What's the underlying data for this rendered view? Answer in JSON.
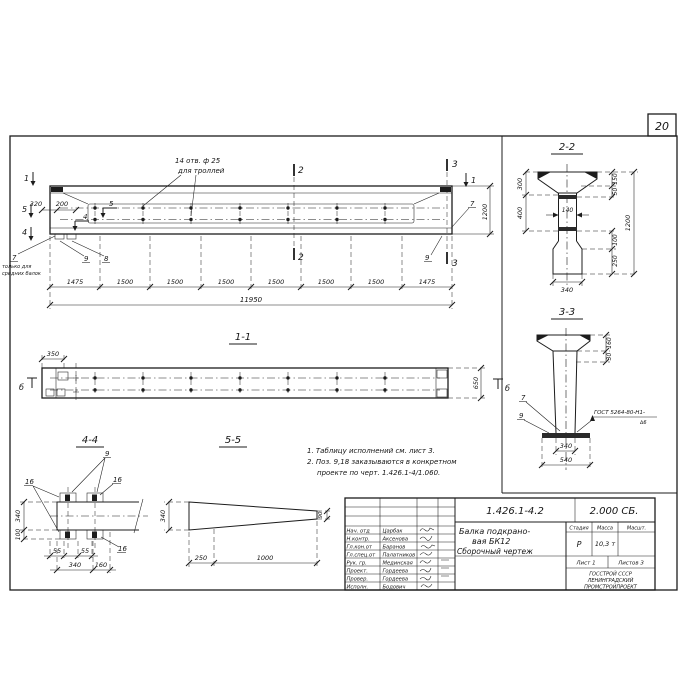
{
  "sheet": {
    "number": "20"
  },
  "elevation": {
    "holes_note_line1": "14 отв. ф 25",
    "holes_note_line2": "для троллей",
    "dim_320": "320",
    "dim_200": "200",
    "dim_height": "1200",
    "mark_1_left": "1",
    "mark_5_left": "5",
    "mark_4_left": "4",
    "mark_5_inner": "5",
    "mark_4_inner": "4",
    "mark_2_top": "2",
    "mark_2_bottom": "2",
    "mark_3_top": "3",
    "mark_3_bottom": "3",
    "mark_1_right": "1",
    "pos_7_left": "7",
    "pos_7_note_line1": "только для",
    "pos_7_note_line2": "средних балок",
    "pos_9_left": "9",
    "pos_8_left": "8",
    "pos_7_right": "7",
    "pos_9_right": "9",
    "chain": [
      "1475",
      "1500",
      "1500",
      "1500",
      "1500",
      "1500",
      "1500",
      "1475"
    ],
    "dim_total": "11950"
  },
  "section_2_2": {
    "title": "2-2",
    "dim_300": "300",
    "dim_400": "400",
    "dim_150": "150",
    "dim_50": "50",
    "dim_140": "140",
    "dim_1200": "1200",
    "dim_100": "100",
    "dim_250": "250",
    "dim_340": "340"
  },
  "section_3_3": {
    "title": "3-3",
    "dim_160": "160",
    "dim_30": "30",
    "pos_7": "7",
    "pos_9": "9",
    "weld_note": "ГОСТ 5264-80-Н1-",
    "weld_note_sub": "∆6",
    "dim_340": "340",
    "dim_540": "540"
  },
  "view_1_1": {
    "title": "1-1",
    "dim_350": "350",
    "dim_650": "650",
    "mark_b_left": "б",
    "mark_b_right": "б"
  },
  "view_4_4": {
    "title": "4-4",
    "pos_9": "9",
    "pos_16_top_left": "16",
    "pos_16_top_right": "16",
    "pos_16_bottom": "16",
    "dim_340_left": "340",
    "dim_100_left": "100",
    "dim_55_a": "55",
    "dim_55_b": "55",
    "dim_340_bottom": "340",
    "dim_160_bottom": "160"
  },
  "view_5_5": {
    "title": "5-5",
    "dim_340": "340",
    "dim_90": "90",
    "dim_250": "250",
    "dim_1000": "1000"
  },
  "notes": {
    "line1": "1. Таблицу исполнений см. лист 3.",
    "line2": "2. Поз. 9,18 заказываются в конкретном",
    "line3": "проекте по черт. 1.426.1-4/1.060."
  },
  "stamp": {
    "doc_number": "1.426.1-4.2",
    "doc_code": "2.000 СБ.",
    "title_line1": "Балка подкрано-",
    "title_line2": "вая БК12",
    "title_line3": "Сборочный чертеж",
    "col_stage": "Стадия",
    "col_mass": "Масса",
    "col_scale": "Масшт.",
    "stage": "Р",
    "mass": "10,3 т",
    "scale": "",
    "sheet": "Лист 1",
    "sheets": "Листов 3",
    "org_line1": "ГОССТРОЙ СССР",
    "org_line2": "ЛЕНИНГРАДСКИЙ",
    "org_line3": "ПРОМСТРОЙПРОЕКТ",
    "rows": [
      {
        "role": "Нач. отд",
        "name": "Царбак"
      },
      {
        "role": "Н.контр.",
        "name": "Аксенова"
      },
      {
        "role": "Гл.кон.от",
        "name": "Баранов"
      },
      {
        "role": "Гл.спец.от",
        "name": "Палатников"
      },
      {
        "role": "Рук. гр.",
        "name": "Мединская"
      },
      {
        "role": "Проект.",
        "name": "Гордеева"
      },
      {
        "role": "Провер.",
        "name": "Гордеева"
      },
      {
        "role": "Исполн.",
        "name": "Бодович"
      }
    ]
  }
}
